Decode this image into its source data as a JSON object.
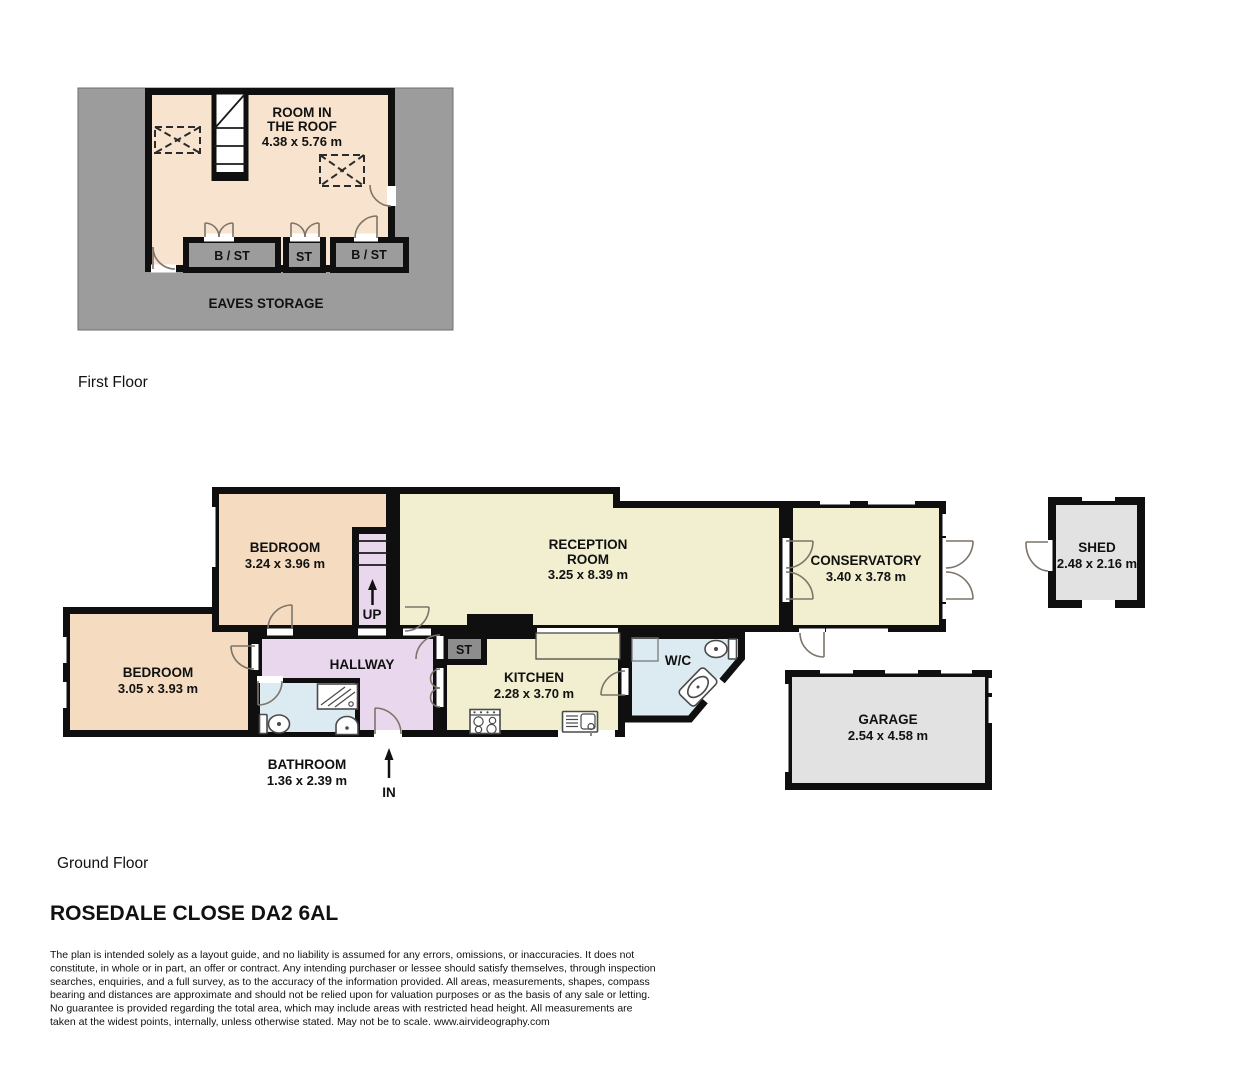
{
  "plan": {
    "title": "ROSEDALE CLOSE DA2 6AL",
    "first_floor": {
      "floor_label": "First Floor",
      "room_name_1": "ROOM IN",
      "room_name_2": "THE ROOF",
      "room_dims": "4.38 x 5.76 m",
      "storage_1": "B / ST",
      "storage_2": "ST",
      "storage_3": "B / ST",
      "eaves_label": "EAVES STORAGE"
    },
    "ground_floor": {
      "floor_label": "Ground Floor",
      "bedroom1_name": "BEDROOM",
      "bedroom1_dims": "3.24 x 3.96 m",
      "bedroom2_name": "BEDROOM",
      "bedroom2_dims": "3.05 x 3.93 m",
      "reception_name_1": "RECEPTION",
      "reception_name_2": "ROOM",
      "reception_dims": "3.25 x 8.39 m",
      "conservatory_name": "CONSERVATORY",
      "conservatory_dims": "3.40 x 3.78 m",
      "shed_name": "SHED",
      "shed_dims": "2.48 x 2.16 m",
      "garage_name": "GARAGE",
      "garage_dims": "2.54 x 4.58 m",
      "kitchen_name": "KITCHEN",
      "kitchen_dims": "2.28 x 3.70 m",
      "hallway_name": "HALLWAY",
      "bathroom_name": "BATHROOM",
      "bathroom_dims": "1.36 x 2.39 m",
      "wc_name": "W/C",
      "storage_label": "ST",
      "up_label": "UP",
      "in_label": "IN"
    },
    "disclaimer": [
      "The plan is intended solely as a layout guide, and no liability is assumed for any errors, omissions, or inaccuracies. It does not",
      "constitute, in whole or in part, an offer or contract. Any intending purchaser or lessee should satisfy themselves, through inspection",
      "searches, enquiries, and a full survey, as to the accuracy of the information provided. All areas, measurements, shapes, compass",
      "bearing and distances are approximate and should not be relied upon for valuation purposes or as the basis of any sale or letting.",
      "No guarantee is provided regarding the total area, which may include areas with restricted head height. All measurements are",
      "taken at the widest points, internally, unless otherwise stated. May not be to scale. www.airvideography.com"
    ]
  },
  "icons": {
    "up_arrow": "up-arrow-icon",
    "in_arrow": "in-arrow-icon",
    "skylight_boxes": "skylight-dashed-box-icon"
  },
  "colors": {
    "wall": "#0f0f0f",
    "bedroom_fill": "#f5dcc0",
    "roof_room_fill": "#f8e4ce",
    "living_fill": "#f1efcf",
    "hall_fill": "#e9d8ed",
    "bath_fill": "#dceaf2",
    "eaves_gray": "#9c9c9c",
    "outbuilding_gray": "#e2e2e2",
    "storage_gray": "#8d8d8d",
    "door_arc": "#7d746a",
    "text": "#111111",
    "background": "#ffffff"
  }
}
